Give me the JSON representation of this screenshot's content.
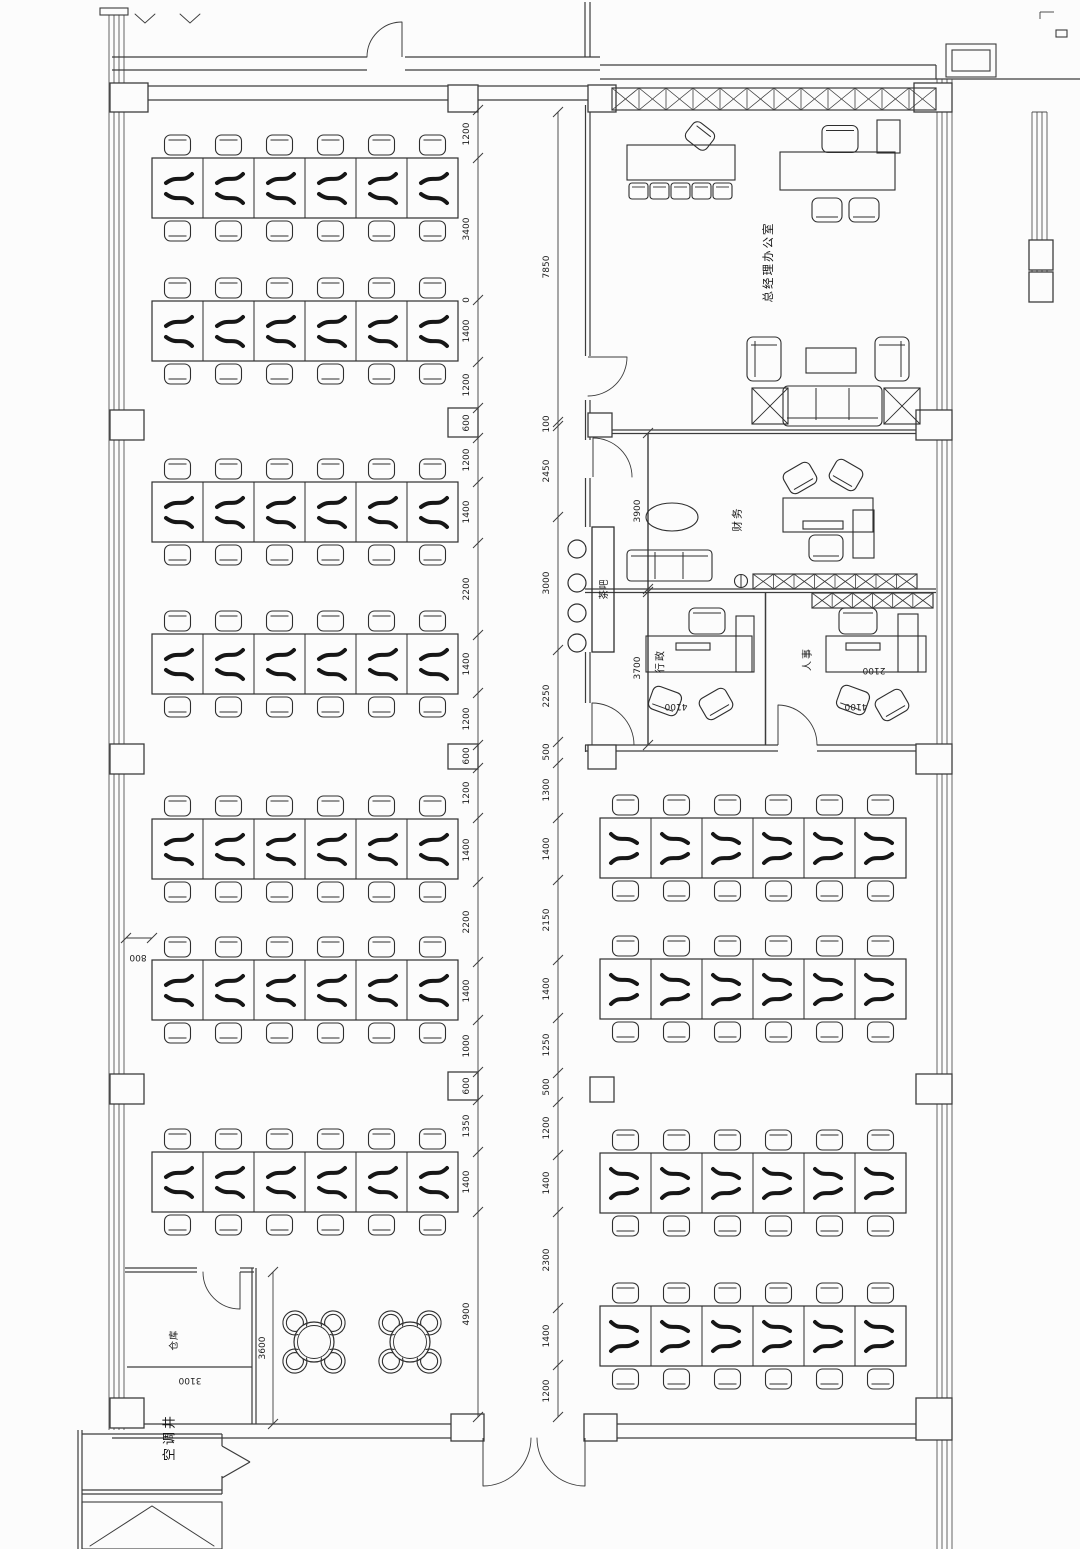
{
  "rooms": {
    "gm_office": "总经理办公室",
    "finance": "财务",
    "admin": "行政",
    "hr": "人事",
    "tea_bar": "茶吧",
    "warehouse": "仓库",
    "ac_shaft": "空调井"
  },
  "dimensions": {
    "chain_left": [
      "1200",
      "3400",
      "0",
      "1400",
      "1200",
      "600",
      "1200",
      "1400",
      "2200",
      "1400",
      "1200",
      "600",
      "1200",
      "1400",
      "2200",
      "1400",
      "1000",
      "600",
      "1350",
      "1400",
      "4900"
    ],
    "chain_right": [
      "7850",
      "100",
      "2450",
      "3000",
      "2250",
      "500",
      "1300",
      "1400",
      "2150",
      "1400",
      "1250",
      "500",
      "1200",
      "1400",
      "2300",
      "1400",
      "1200"
    ],
    "finance_depth": "3900",
    "admin_depth": "3700",
    "warehouse_width": "3600",
    "warehouse_depth": "3100",
    "aisle": "800",
    "admin_width": "4100",
    "hr_width": "4100",
    "hr_desk": "2100"
  },
  "colors": {
    "line": "#3c3c3c",
    "furniture": "#2e2e2e",
    "glyph": "#161616",
    "bg": "#fcfcfc"
  }
}
